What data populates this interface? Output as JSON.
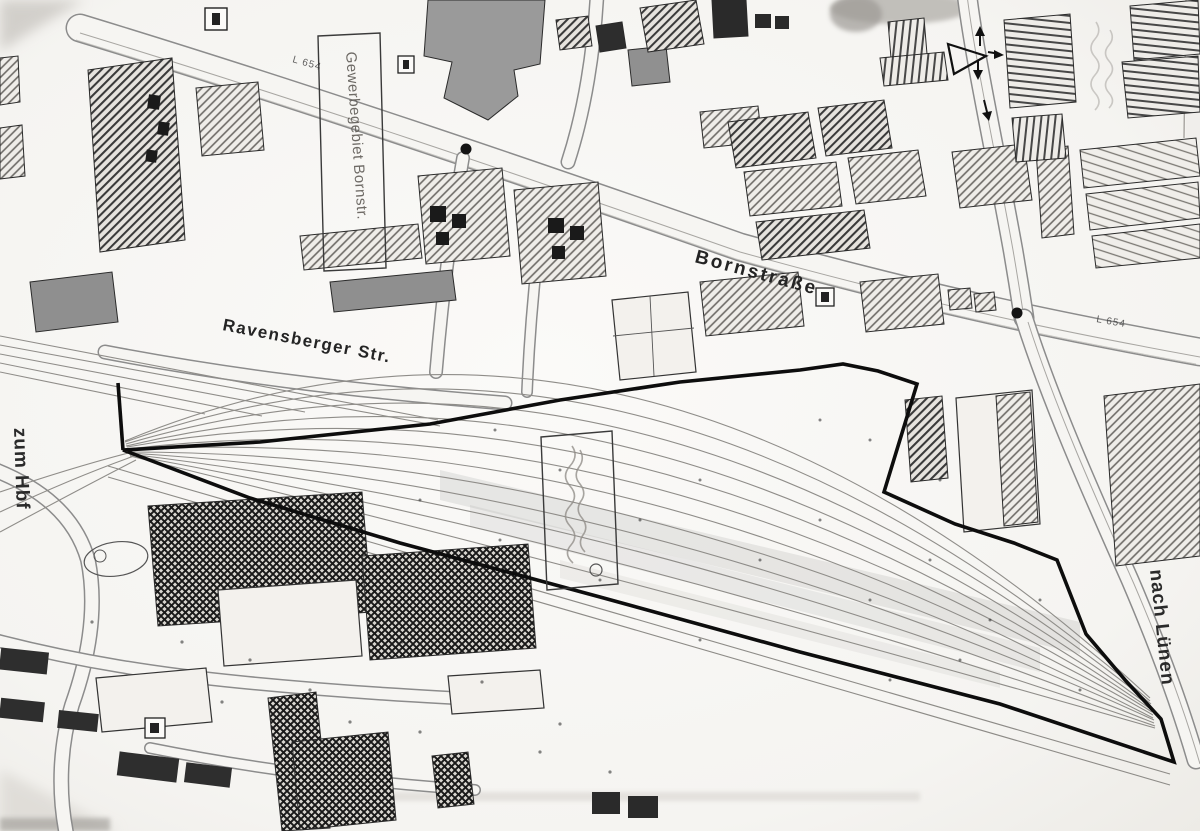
{
  "map": {
    "street_labels": {
      "bornstrasse": "Bornstraße",
      "ravensberger_str": "Ravensberger Str."
    },
    "direction_labels": {
      "zum_hbf": "zum Hbf",
      "nach_luenen": "nach Lünen"
    },
    "area_labels": {
      "gewerbegebiet_bornstr": "Gewerbegebiet Bornstr."
    },
    "road_numbers": {
      "west": "L 654",
      "east": "L 654"
    },
    "colors": {
      "paper": "#f6f5f2",
      "ink": "#1c1c1c",
      "site_boundary": "#0d0d0d",
      "building_gray": "#8f8f8f",
      "hatch_dark": "#3a3a3a"
    }
  }
}
